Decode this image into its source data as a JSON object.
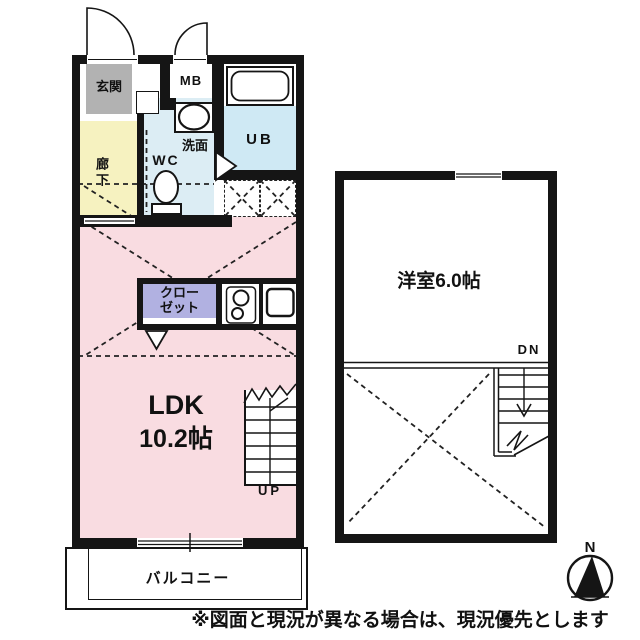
{
  "first_floor": {
    "genkan_label": "玄関",
    "mb_label": "MB",
    "ub_label": "UB",
    "senmen_label": "洗面",
    "wc_label": "WC",
    "rouka_label": "廊下",
    "closet_lines": [
      "クロー",
      "ゼット"
    ],
    "ldk_label": "LDK",
    "ldk_size": "10.2帖",
    "stairs_up_label": "UP",
    "balcony_label": "バルコニー"
  },
  "second_floor": {
    "room_label": "洋室6.0帖",
    "stairs_down_label": "DN"
  },
  "compass": {
    "north_label": "N"
  },
  "footer": {
    "disclaimer": "※図面と現況が異なる場合は、現況優先とします"
  },
  "colors": {
    "wall": "#151515",
    "genkan": "#b2b2b2",
    "rouka": "#f6f2c0",
    "washroom": "#dcedf4",
    "unit_bath": "#cfe9f4",
    "ldk": "#f9dce1",
    "closet": "#b1b1e1"
  }
}
